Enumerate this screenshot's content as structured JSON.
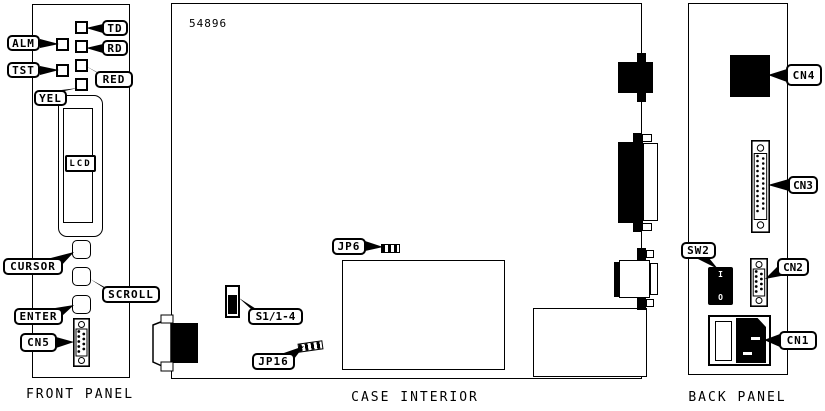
{
  "part_number": "54896",
  "sections": {
    "front_panel": "FRONT PANEL",
    "case_interior": "CASE INTERIOR",
    "back_panel": "BACK PANEL"
  },
  "callouts": {
    "alm": "ALM",
    "tst": "TST",
    "td": "TD",
    "rd": "RD",
    "red": "RED",
    "yel": "YEL",
    "lcd": "LCD",
    "cursor": "CURSOR",
    "scroll": "SCROLL",
    "enter": "ENTER",
    "cn5": "CN5",
    "jp6": "JP6",
    "s1": "S1/1-4",
    "jp16": "JP16",
    "cn4": "CN4",
    "cn3": "CN3",
    "sw2": "SW2",
    "cn2": "CN2",
    "cn1": "CN1"
  },
  "power_switch": {
    "on": "I",
    "off": "O"
  },
  "colors": {
    "ink": "#000000",
    "paper": "#ffffff"
  }
}
